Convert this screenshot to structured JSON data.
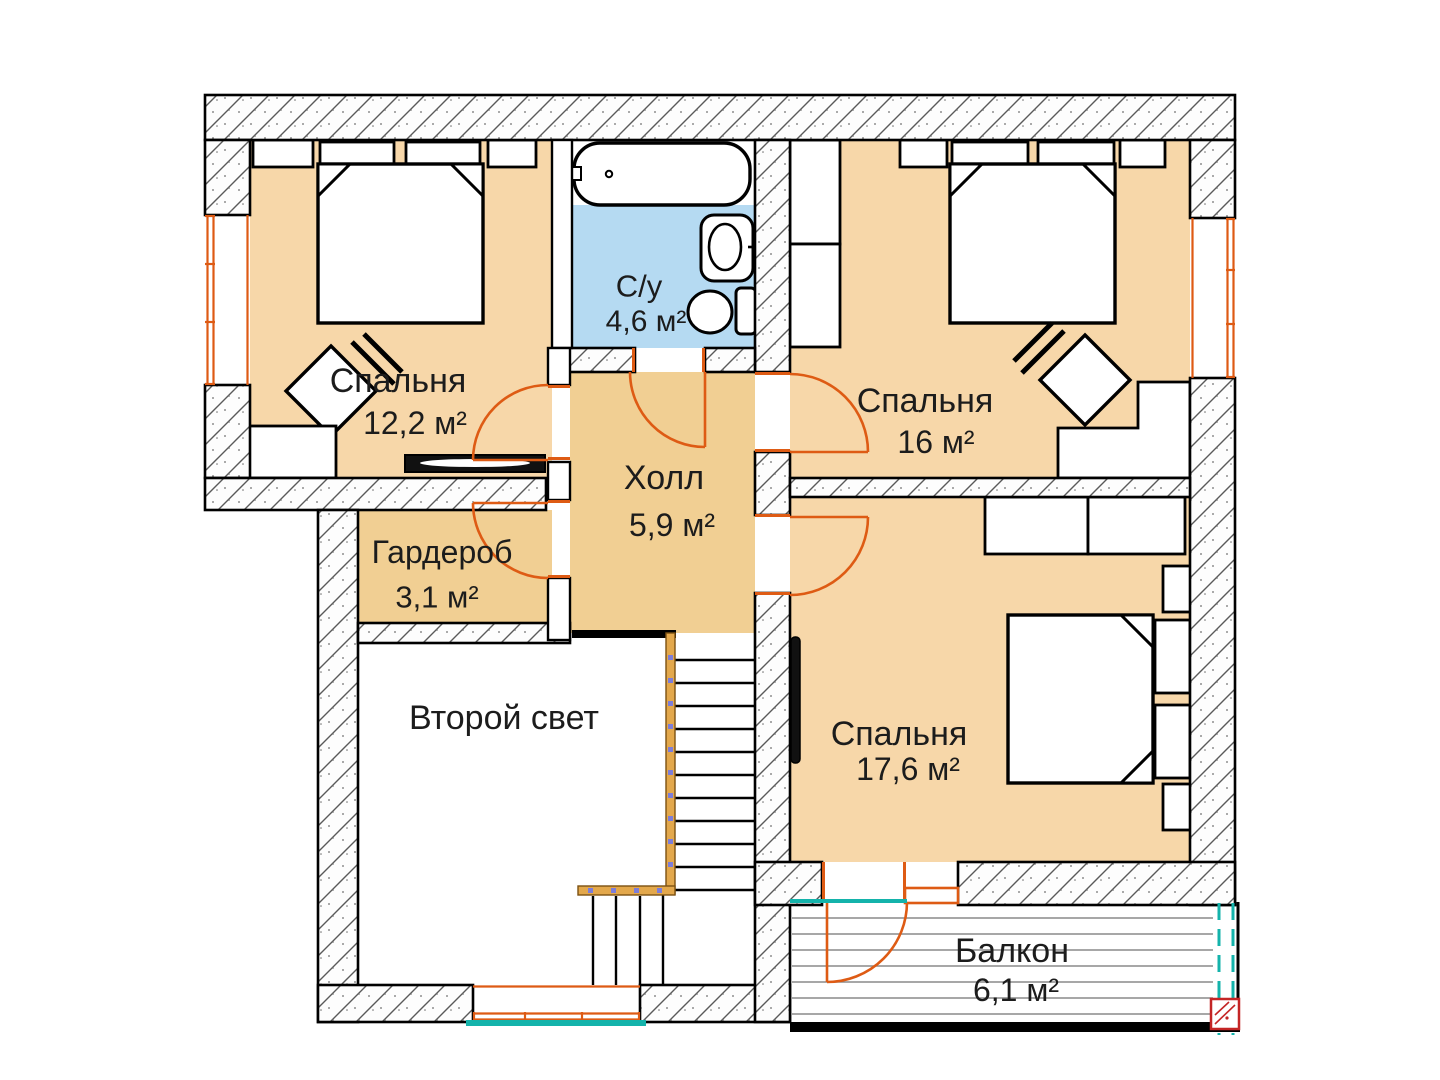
{
  "plan": {
    "type": "apartment-floor-plan",
    "language": "ru",
    "rooms": {
      "bedroom1": {
        "name": "Спальня",
        "area": "12,2 м²"
      },
      "bathroom": {
        "name": "С/у",
        "area": "4,6 м²"
      },
      "bedroom2": {
        "name": "Спальня",
        "area": "16 м²"
      },
      "hall": {
        "name": "Холл",
        "area": "5,9 м²"
      },
      "wardrobe": {
        "name": "Гардероб",
        "area": "3,1 м²"
      },
      "void": {
        "name": "Второй свет"
      },
      "bedroom3": {
        "name": "Спальня",
        "area": "17,6 м²"
      },
      "balcony": {
        "name": "Балкон",
        "area": "6,1 м²"
      }
    },
    "colors": {
      "bedroom_fill": "#f7d7a9",
      "hall_fill": "#f1cf93",
      "bathroom_fill": "#b5daf2",
      "door_window_accent": "#de5b14",
      "glazing_teal": "#14b3ab",
      "drain_red": "#c42525",
      "railing_tan": "#e3a84c",
      "wall_line": "#000000"
    }
  }
}
